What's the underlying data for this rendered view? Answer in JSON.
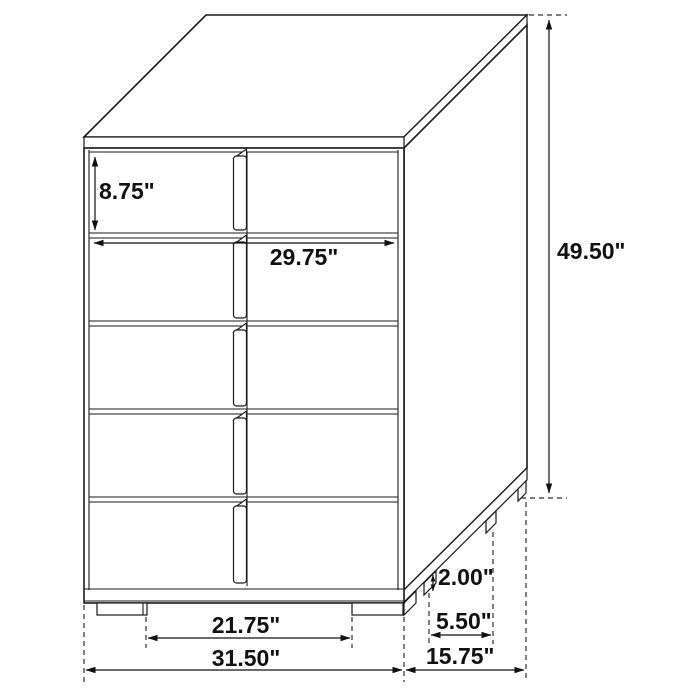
{
  "diagram": {
    "subject": "five-drawer-chest-dimension-drawing",
    "unit": "inches",
    "style": {
      "line_color": "#1a1a1a",
      "background": "#ffffff",
      "label_color": "#111111"
    },
    "labels": {
      "drawer_height": "8.75\"",
      "drawer_width": "29.75\"",
      "overall_height": "49.50\"",
      "leg_height": "2.00\"",
      "side_leg_spacing": "5.50\"",
      "front_leg_spacing": "21.75\"",
      "overall_width": "31.50\"",
      "overall_depth": "15.75\""
    }
  }
}
